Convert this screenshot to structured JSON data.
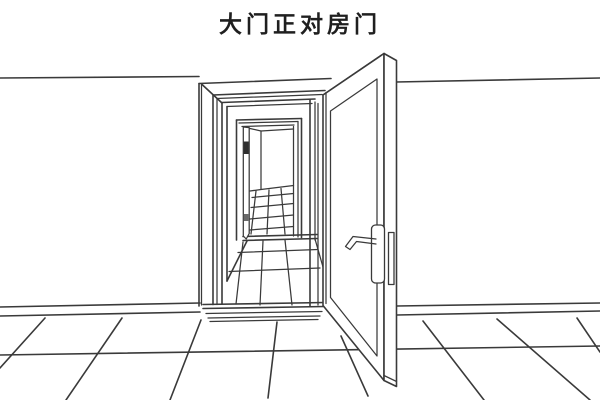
{
  "title": "大门正对房门",
  "colors": {
    "background": "#ffffff",
    "line": "#3a3a3a",
    "text": "#1f1f1f",
    "handle_dark": "#2e2e2e"
  },
  "scene": {
    "caption": "大门正对房门"
  }
}
